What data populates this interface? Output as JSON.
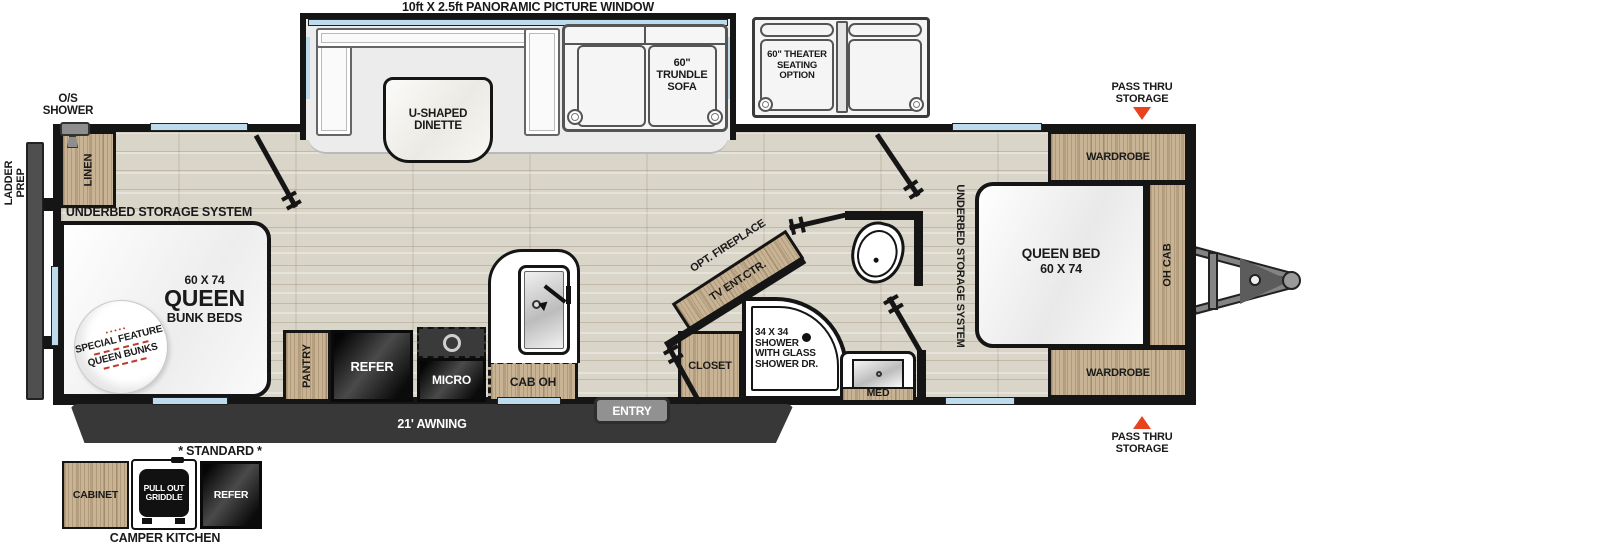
{
  "colors": {
    "wall": "#151515",
    "wood": "#c8b495",
    "floor": "#dad5c9",
    "window_blue": "#bcdcee",
    "accent_red": "#e8431f",
    "awning_dark": "#383838"
  },
  "top_note": "10ft X 2.5ft PANORAMIC PICTURE WINDOW",
  "slide": {
    "dinette": "U-SHAPED DINETTE",
    "sofa": "60\" TRUNDLE SOFA"
  },
  "theater": {
    "label": "60\" THEATER SEATING OPTION"
  },
  "rear": {
    "os_shower": "O/S\nSHOWER",
    "ladder_prep": "LADDER\nPREP"
  },
  "bunk_room": {
    "linen": "LINEN",
    "underbed": "UNDERBED STORAGE SYSTEM",
    "bed_size": "60 X 74",
    "bed_name": "QUEEN",
    "bed_sub": "BUNK BEDS",
    "badge_top": "SPECIAL FEATURE",
    "badge_bottom": "QUEEN BUNKS"
  },
  "kitchen": {
    "pantry": "PANTRY",
    "refer": "REFER",
    "micro": "MICRO",
    "cab_oh": "CAB OH"
  },
  "bath": {
    "opt_fireplace": "OPT. FIREPLACE",
    "tv": "TV ENT.CTR.",
    "closet": "CLOSET",
    "shower": "34 X 34\nSHOWER\nWITH GLASS\nSHOWER DR.",
    "med": "MED"
  },
  "bedroom": {
    "underbed": "UNDERBED STORAGE SYSTEM",
    "bed_name": "QUEEN BED",
    "bed_size": "60 X 74",
    "oh_cab": "OH CAB",
    "wardrobe_rear": "WARDROBE",
    "wardrobe_front": "WARDROBE",
    "pass_thru_top": "PASS THRU\nSTORAGE",
    "pass_thru_bottom": "PASS THRU\nSTORAGE"
  },
  "exterior": {
    "awning": "21' AWNING",
    "entry": "ENTRY"
  },
  "camper_kitchen": {
    "standard": "* STANDARD *",
    "cabinet": "CABINET",
    "griddle": "PULL OUT\nGRIDDLE",
    "refer": "REFER",
    "title": "CAMPER KITCHEN"
  }
}
